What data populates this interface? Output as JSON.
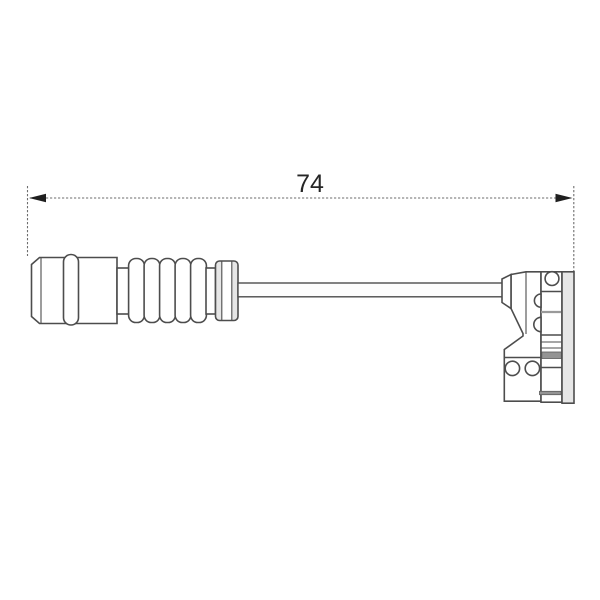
{
  "page": {
    "background": "#ffffff",
    "content_type": "technical-part-drawing"
  },
  "dimension": {
    "label": "74"
  },
  "colors": {
    "outline": "#4d4d4d",
    "dimension_line": "#6e6e6e",
    "arrow": "#1f1f1f",
    "text": "#262626",
    "light_fill": "#e6e6e6",
    "mid_fill": "#949494",
    "background": "#ffffff"
  }
}
